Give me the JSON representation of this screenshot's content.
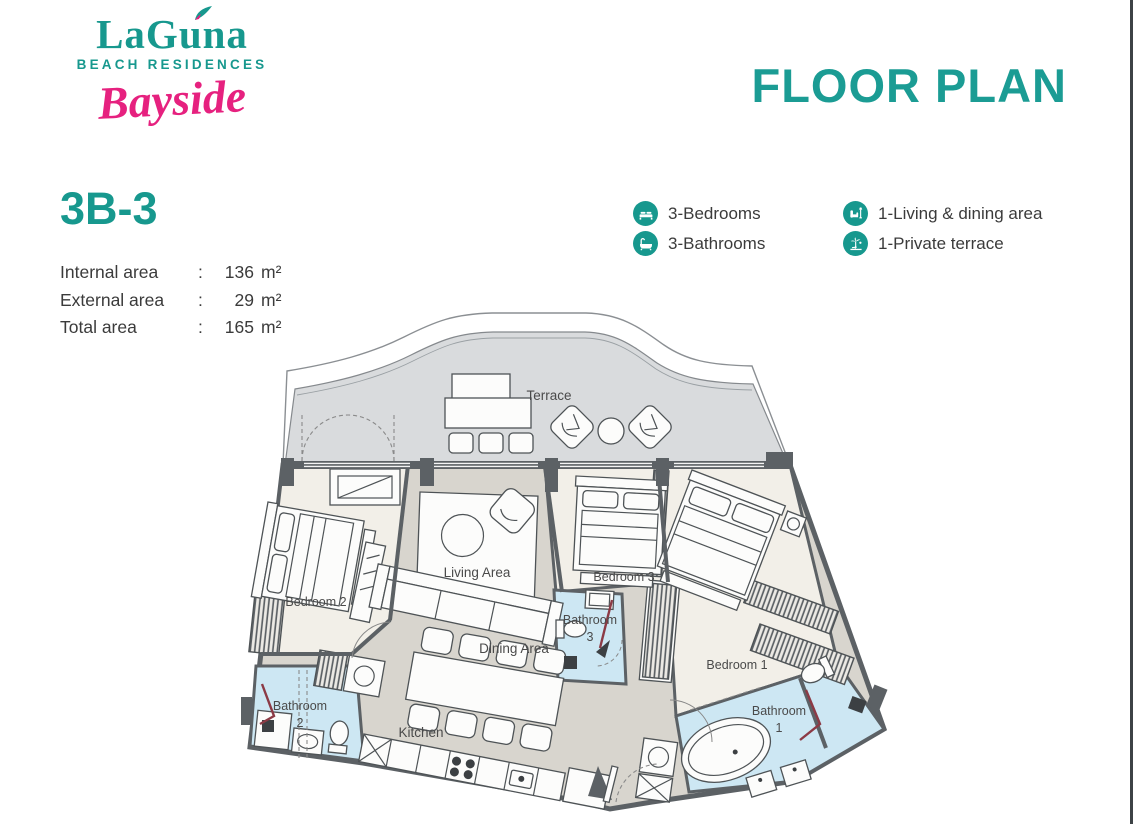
{
  "brand": {
    "name": "LaGuna",
    "tagline": "BEACH RESIDENCES",
    "script": "Bayside",
    "leaf_icon": "leaf-icon"
  },
  "title": "FLOOR PLAN",
  "unit": {
    "name": "3B-3",
    "colon": ":",
    "areas": [
      {
        "label": "Internal area",
        "value": "136",
        "unit": "m²"
      },
      {
        "label": "External area",
        "value": "29",
        "unit": "m²"
      },
      {
        "label": "Total area",
        "value": "165",
        "unit": "m²"
      }
    ]
  },
  "legend": [
    {
      "icon": "bed-icon",
      "label": "3-Bedrooms"
    },
    {
      "icon": "bathtub-icon",
      "label": "3-Bathrooms"
    },
    {
      "icon": "sofa-icon",
      "label": "1-Living & dining area"
    },
    {
      "icon": "terrace-icon",
      "label": "1-Private terrace"
    }
  ],
  "floorplan": {
    "rooms": {
      "terrace": "Terrace",
      "living": "Living Area",
      "dining": "Dining Area",
      "kitchen": "Kitchen",
      "bedroom1": "Bedroom 1",
      "bedroom2": "Bedroom 2",
      "bedroom3": "Bedroom 3",
      "bathroom1_line1": "Bathroom",
      "bathroom1_line2": "1",
      "bathroom2_line1": "Bathroom",
      "bathroom2_line2": "2",
      "bathroom3_line1": "Bathroom",
      "bathroom3_line2": "3"
    },
    "palette": {
      "teal": "#17988E",
      "title_teal": "#1B9C94",
      "pink": "#E6217F",
      "text": "#3B3B3B",
      "label": "#4A4A4A",
      "wall": "#5C6165",
      "floor": "#D8D5CE",
      "terrace": "#D9DBDD",
      "bedroom": "#F2EFE8",
      "bathroom": "#CDE7F3",
      "accent_red": "#8C3A45"
    }
  }
}
